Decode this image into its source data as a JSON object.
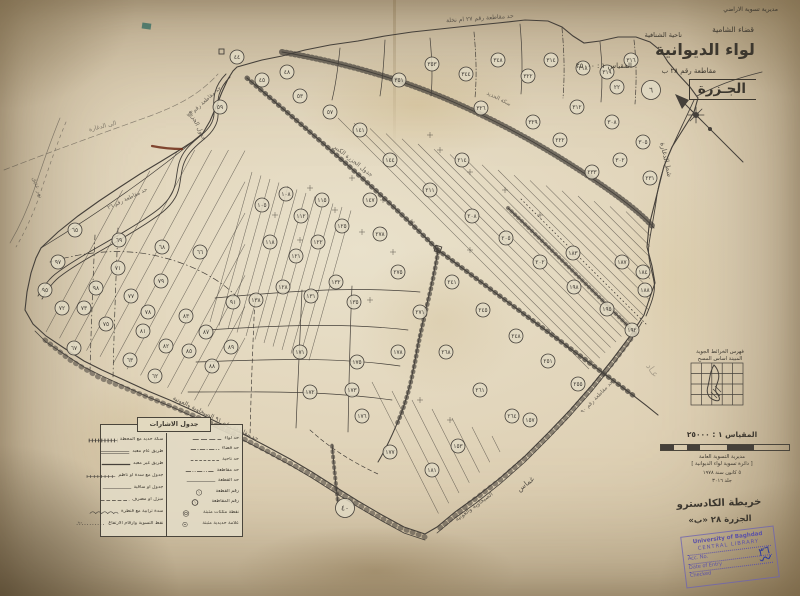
{
  "title_block": {
    "agency": "مديرية تسوية الاراضي",
    "qada": "قضاء الشامية",
    "nahiya": "ناحية الشنافية",
    "liwa": "لواء الديوانية",
    "scale_small": "المقياس ١ : ٢٥٠٠٠",
    "muqataa": "مقاطعة رقم ٢٨ ب",
    "name_box": "الجـزرة"
  },
  "index_map": {
    "caption_line1": "فهرس الخرائط الجوية",
    "caption_line2": "المبينة اساس المسح"
  },
  "scale_block": {
    "heading": "المقياس ١ : ٢٥٠٠٠",
    "note1": "مديرية التسوية العامة",
    "note2": "[ دائرة تسوية لواء الديوانية ]",
    "note3": "٥ كانون سنة ١٩٧٨",
    "note4": "جلد ٣٠١٦"
  },
  "cadastre_note": {
    "line1": "خريطة الكادسترو",
    "line2": "الجزرة ٢٨ «ب»"
  },
  "stamp": {
    "line1": "University of Baghdad",
    "line2": "CENTRAL LIBRARY",
    "line3": "Acc. No.",
    "line4": "Date of Entry",
    "line5": "Checked",
    "scribble": "٣٦"
  },
  "legend": {
    "title": "جدول الاشارات",
    "right_rows": [
      {
        "sym": "dash-long",
        "label": "حد لواء"
      },
      {
        "sym": "dash-dot",
        "label": "حد قضاء"
      },
      {
        "sym": "dash-short",
        "label": "حد ناحية"
      },
      {
        "sym": "dash-dot-dot",
        "label": "حد مقاطعة"
      },
      {
        "sym": "solid-thin",
        "label": "حد القطعة"
      },
      {
        "sym": "circle-num",
        "label": "رقم القطعة"
      },
      {
        "sym": "circle-num2",
        "label": "رقم المقاطعة"
      },
      {
        "sym": "circle-double",
        "label": "نقطة مثلثات مثبتة"
      },
      {
        "sym": "circle-dot",
        "label": "علامة حديدية مثبتة"
      }
    ],
    "left_rows": [
      {
        "sym": "railway",
        "label": "سكة حديد مع المحطة"
      },
      {
        "sym": "double-line",
        "label": "طريق عام معبد"
      },
      {
        "sym": "solid-thick",
        "label": "طريق غير معبد"
      },
      {
        "sym": "ticked",
        "label": "جدول مع سدة او ناظم"
      },
      {
        "sym": "solid-thin",
        "label": "جدول او ساقية"
      },
      {
        "sym": "dashed",
        "label": "مبزل او مصرف"
      },
      {
        "sym": "bumps",
        "label": "سدة ترابية مع قنطرة"
      },
      {
        "sym": "dotted-num",
        "label": "نقط التسوية وارقام الارتفاع"
      }
    ]
  },
  "map_labels": [
    {
      "t": "حد مقاطعة رقم ٢٧ ام نخلة",
      "x": 480,
      "y": 20,
      "r": -4,
      "s": 6,
      "o": 0.8
    },
    {
      "t": "جدول الجزرة",
      "x": 196,
      "y": 126,
      "r": 64,
      "s": 6,
      "o": 0.8
    },
    {
      "t": "جدول الجزرة الكبير",
      "x": 352,
      "y": 162,
      "r": 38,
      "s": 6,
      "o": 0.8
    },
    {
      "t": "سكة الحديد",
      "x": 498,
      "y": 100,
      "r": 27,
      "s": 5.5,
      "o": 0.7
    },
    {
      "t": "شط الدغارة",
      "x": 664,
      "y": 160,
      "r": 78,
      "s": 7,
      "o": 0.85
    },
    {
      "t": "حد مقاطعة رقم ٢٥",
      "x": 205,
      "y": 103,
      "r": -42,
      "s": 5.5,
      "o": 0.75
    },
    {
      "t": "حد مقاطعة رقم ٢٦",
      "x": 128,
      "y": 200,
      "r": -26,
      "s": 5.5,
      "o": 0.75
    },
    {
      "t": "حد مقاطعة رقم ٩١ الصبخاوية والعونية",
      "x": 215,
      "y": 420,
      "r": 26,
      "s": 6,
      "o": 0.85
    },
    {
      "t": "الصبخاوية والعونية",
      "x": 475,
      "y": 508,
      "r": -36,
      "s": 6,
      "o": 0.8
    },
    {
      "t": "غماس",
      "x": 527,
      "y": 486,
      "r": -38,
      "s": 7.5,
      "o": 0.85
    },
    {
      "t": "حد مقاطعة رقم ٩٠",
      "x": 598,
      "y": 398,
      "r": -46,
      "s": 5.5,
      "o": 0.75
    },
    {
      "t": "نهر عتيق",
      "x": 36,
      "y": 188,
      "r": 72,
      "s": 6,
      "o": 0.55
    },
    {
      "t": "الى الدغارة",
      "x": 103,
      "y": 128,
      "r": -14,
      "s": 6,
      "o": 0.6
    },
    {
      "t": "عـاد",
      "x": 650,
      "y": 372,
      "r": 55,
      "s": 9,
      "o": 0.35
    }
  ],
  "plots": [
    {
      "x": 237,
      "y": 57,
      "n": "٤٤"
    },
    {
      "x": 262,
      "y": 80,
      "n": "٤٥"
    },
    {
      "x": 287,
      "y": 72,
      "n": "٤٨"
    },
    {
      "x": 300,
      "y": 96,
      "n": "٥٣"
    },
    {
      "x": 330,
      "y": 112,
      "n": "٥٧"
    },
    {
      "x": 220,
      "y": 107,
      "n": "٥٩"
    },
    {
      "x": 399,
      "y": 80,
      "n": "٣٥١"
    },
    {
      "x": 432,
      "y": 64,
      "n": "٣٥٣"
    },
    {
      "x": 466,
      "y": 74,
      "n": "٣٤٤"
    },
    {
      "x": 498,
      "y": 60,
      "n": "٣٤٨"
    },
    {
      "x": 528,
      "y": 76,
      "n": "٣٢٢"
    },
    {
      "x": 551,
      "y": 60,
      "n": "٣١٤"
    },
    {
      "x": 583,
      "y": 68,
      "n": "٣١٨"
    },
    {
      "x": 607,
      "y": 72,
      "n": "٣١٩"
    },
    {
      "x": 631,
      "y": 60,
      "n": "٣١٦"
    },
    {
      "x": 617,
      "y": 87,
      "n": "٢٢"
    },
    {
      "x": 651,
      "y": 90,
      "n": "٦",
      "big": 1
    },
    {
      "x": 481,
      "y": 108,
      "n": "٣٢٦"
    },
    {
      "x": 533,
      "y": 122,
      "n": "٣٢٩"
    },
    {
      "x": 577,
      "y": 107,
      "n": "٣١٢"
    },
    {
      "x": 612,
      "y": 122,
      "n": "٣٠٨"
    },
    {
      "x": 643,
      "y": 142,
      "n": "٣٠٥"
    },
    {
      "x": 620,
      "y": 160,
      "n": "٣٠٢"
    },
    {
      "x": 560,
      "y": 140,
      "n": "٢٢٢"
    },
    {
      "x": 592,
      "y": 172,
      "n": "٢٣٣"
    },
    {
      "x": 650,
      "y": 178,
      "n": "٢٣١"
    },
    {
      "x": 573,
      "y": 253,
      "n": "١٨٣"
    },
    {
      "x": 622,
      "y": 262,
      "n": "١٨٧"
    },
    {
      "x": 643,
      "y": 272,
      "n": "١٨٤"
    },
    {
      "x": 645,
      "y": 290,
      "n": "١٨٨"
    },
    {
      "x": 462,
      "y": 160,
      "n": "٢١٤"
    },
    {
      "x": 430,
      "y": 190,
      "n": "٢١١"
    },
    {
      "x": 472,
      "y": 216,
      "n": "٢٠٨"
    },
    {
      "x": 506,
      "y": 238,
      "n": "٢٠٥"
    },
    {
      "x": 540,
      "y": 262,
      "n": "٢٠٢"
    },
    {
      "x": 574,
      "y": 287,
      "n": "١٩٨"
    },
    {
      "x": 607,
      "y": 309,
      "n": "١٩٥"
    },
    {
      "x": 632,
      "y": 330,
      "n": "١٩٢"
    },
    {
      "x": 452,
      "y": 282,
      "n": "٢٤١"
    },
    {
      "x": 483,
      "y": 310,
      "n": "٢٤٥"
    },
    {
      "x": 516,
      "y": 336,
      "n": "٢٤٨"
    },
    {
      "x": 548,
      "y": 361,
      "n": "٢٥١"
    },
    {
      "x": 578,
      "y": 384,
      "n": "٢٥٥"
    },
    {
      "x": 480,
      "y": 390,
      "n": "٢٦١"
    },
    {
      "x": 512,
      "y": 416,
      "n": "٢٦٤"
    },
    {
      "x": 446,
      "y": 352,
      "n": "٢٦٨"
    },
    {
      "x": 420,
      "y": 312,
      "n": "٢٧١"
    },
    {
      "x": 398,
      "y": 272,
      "n": "٢٧٥"
    },
    {
      "x": 380,
      "y": 234,
      "n": "٢٧٨"
    },
    {
      "x": 530,
      "y": 420,
      "n": "١٥٧"
    },
    {
      "x": 262,
      "y": 205,
      "n": "١٠٥"
    },
    {
      "x": 286,
      "y": 194,
      "n": "١٠٨"
    },
    {
      "x": 301,
      "y": 216,
      "n": "١١٢"
    },
    {
      "x": 322,
      "y": 200,
      "n": "١١٥"
    },
    {
      "x": 270,
      "y": 242,
      "n": "١١٨"
    },
    {
      "x": 296,
      "y": 256,
      "n": "١٢١"
    },
    {
      "x": 318,
      "y": 242,
      "n": "١٢٢"
    },
    {
      "x": 342,
      "y": 226,
      "n": "١٢٥"
    },
    {
      "x": 283,
      "y": 287,
      "n": "١٢٨"
    },
    {
      "x": 311,
      "y": 296,
      "n": "١٣١"
    },
    {
      "x": 336,
      "y": 282,
      "n": "١٣٢"
    },
    {
      "x": 354,
      "y": 302,
      "n": "١٣٥"
    },
    {
      "x": 256,
      "y": 300,
      "n": "١٣٨"
    },
    {
      "x": 370,
      "y": 200,
      "n": "١٤٧"
    },
    {
      "x": 390,
      "y": 160,
      "n": "١٤٤"
    },
    {
      "x": 360,
      "y": 130,
      "n": "١٤١"
    },
    {
      "x": 300,
      "y": 352,
      "n": "١٧١"
    },
    {
      "x": 310,
      "y": 392,
      "n": "١٧٢"
    },
    {
      "x": 352,
      "y": 390,
      "n": "١٧٣"
    },
    {
      "x": 357,
      "y": 362,
      "n": "١٧٥"
    },
    {
      "x": 362,
      "y": 416,
      "n": "١٧٦"
    },
    {
      "x": 398,
      "y": 352,
      "n": "١٧٨"
    },
    {
      "x": 390,
      "y": 452,
      "n": "١٧٧"
    },
    {
      "x": 432,
      "y": 470,
      "n": "١٨١"
    },
    {
      "x": 458,
      "y": 446,
      "n": "١٥٣"
    },
    {
      "x": 345,
      "y": 508,
      "n": "٤٠",
      "big": 1
    },
    {
      "x": 58,
      "y": 262,
      "n": "٩٧"
    },
    {
      "x": 62,
      "y": 308,
      "n": "٧٢"
    },
    {
      "x": 84,
      "y": 308,
      "n": "٧٣"
    },
    {
      "x": 106,
      "y": 324,
      "n": "٧٥"
    },
    {
      "x": 74,
      "y": 348,
      "n": "٦٧"
    },
    {
      "x": 118,
      "y": 268,
      "n": "٧١"
    },
    {
      "x": 131,
      "y": 296,
      "n": "٧٧"
    },
    {
      "x": 148,
      "y": 312,
      "n": "٧٨"
    },
    {
      "x": 161,
      "y": 281,
      "n": "٧٩"
    },
    {
      "x": 143,
      "y": 331,
      "n": "٨١"
    },
    {
      "x": 166,
      "y": 346,
      "n": "٨٢"
    },
    {
      "x": 186,
      "y": 316,
      "n": "٨٣"
    },
    {
      "x": 189,
      "y": 351,
      "n": "٨٥"
    },
    {
      "x": 206,
      "y": 332,
      "n": "٨٧"
    },
    {
      "x": 212,
      "y": 366,
      "n": "٨٨"
    },
    {
      "x": 231,
      "y": 347,
      "n": "٨٩"
    },
    {
      "x": 119,
      "y": 240,
      "n": "٦٩"
    },
    {
      "x": 162,
      "y": 247,
      "n": "٦٨"
    },
    {
      "x": 200,
      "y": 252,
      "n": "٦٦"
    },
    {
      "x": 233,
      "y": 302,
      "n": "٩١"
    },
    {
      "x": 130,
      "y": 360,
      "n": "٦٣"
    },
    {
      "x": 155,
      "y": 376,
      "n": "٦٢"
    },
    {
      "x": 96,
      "y": 288,
      "n": "٩٨"
    },
    {
      "x": 45,
      "y": 290,
      "n": "٩٥"
    },
    {
      "x": 75,
      "y": 230,
      "n": "٦٥"
    }
  ],
  "colors": {
    "ink": "#45403a",
    "stamp": "#6a5fae",
    "blue_ink": "#2c3a9e",
    "red_mark": "#6f2c16",
    "teal_mark": "#2f6a60"
  }
}
